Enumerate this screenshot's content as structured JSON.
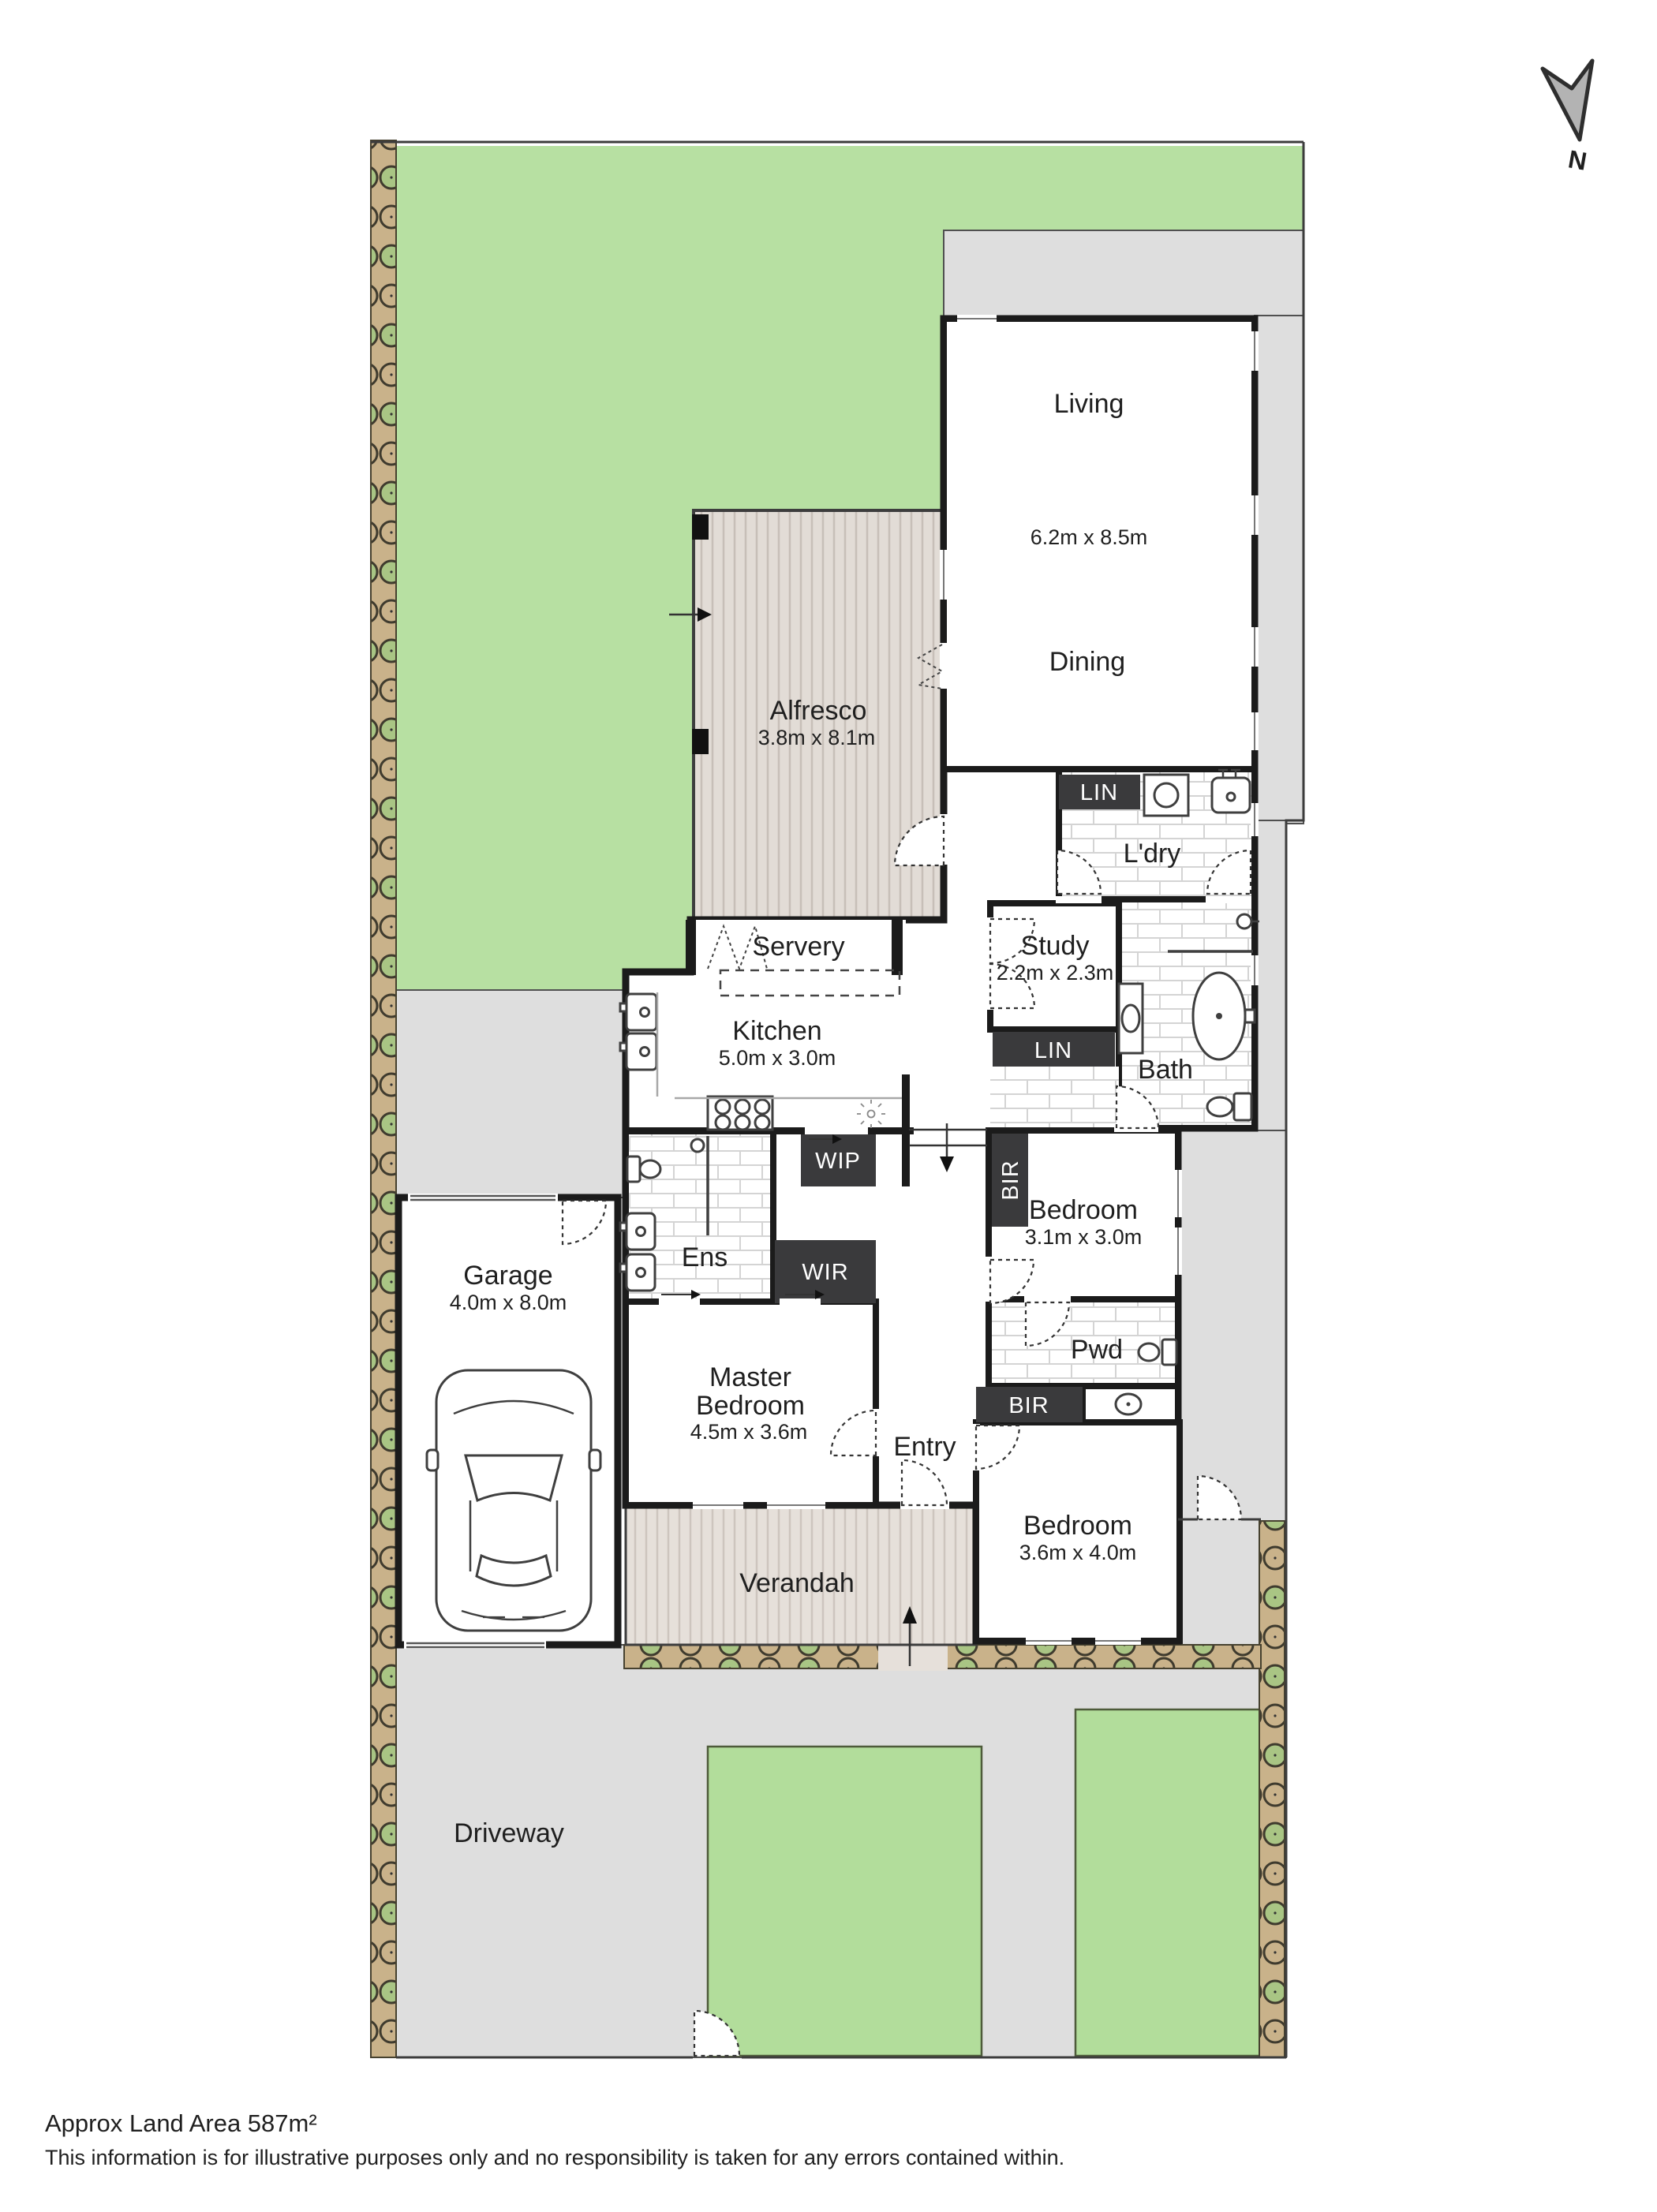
{
  "north": {
    "label": "N"
  },
  "rooms": {
    "living": {
      "label": "Living",
      "dims": "6.2m x 8.5m"
    },
    "dining": {
      "label": "Dining"
    },
    "alfresco": {
      "label": "Alfresco",
      "dims": "3.8m x 8.1m"
    },
    "servery": {
      "label": "Servery"
    },
    "kitchen": {
      "label": "Kitchen",
      "dims": "5.0m x 3.0m"
    },
    "laundry": {
      "label": "L'dry"
    },
    "linen_laundry": {
      "label": "LIN"
    },
    "study": {
      "label": "Study",
      "dims": "2.2m x 2.3m"
    },
    "linen_hall": {
      "label": "LIN"
    },
    "bath": {
      "label": "Bath"
    },
    "wip": {
      "label": "WIP"
    },
    "bedroom_rear": {
      "label": "Bedroom",
      "dims": "3.1m x 3.0m"
    },
    "bir_rear": {
      "label": "BIR"
    },
    "powder": {
      "label": "Pwd"
    },
    "bir_front": {
      "label": "BIR"
    },
    "bedroom_front": {
      "label": "Bedroom",
      "dims": "3.6m x 4.0m"
    },
    "ensuite": {
      "label": "Ens"
    },
    "wir": {
      "label": "WIR"
    },
    "master": {
      "label_line1": "Master",
      "label_line2": "Bedroom",
      "dims": "4.5m x 3.6m"
    },
    "entry": {
      "label": "Entry"
    },
    "garage": {
      "label": "Garage",
      "dims": "4.0m x 8.0m"
    },
    "verandah": {
      "label": "Verandah"
    },
    "driveway": {
      "label": "Driveway"
    }
  },
  "footer": {
    "land_area": "Approx Land Area 587m²",
    "disclaimer": "This information is for illustrative purposes only and no responsibility is taken for any errors contained within."
  },
  "colors": {
    "grass": "#b7e0a2",
    "garden_bed": "#b2dd9b",
    "paving": "#dedede",
    "deck": "#e2dcd6",
    "fence": "#c9b28a",
    "post_green": "#a9c584",
    "wall": "#1b1b1b",
    "dark_box": "#3a3a3c"
  }
}
